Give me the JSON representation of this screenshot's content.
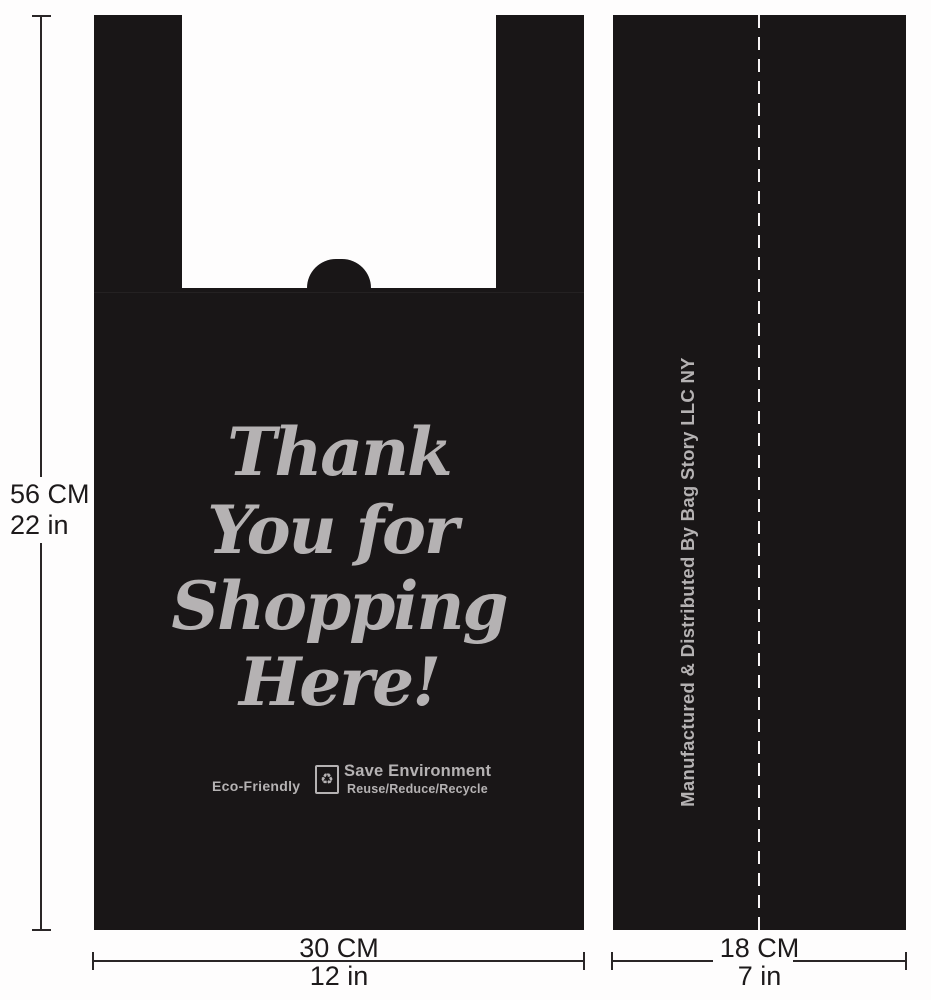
{
  "colors": {
    "bag_black": "#191617",
    "print_gray": "#b5b2b3",
    "line_dark": "#2a2627",
    "page_white": "#fefdfd"
  },
  "height_dimension": {
    "cm": "56 CM",
    "inches": "22 in"
  },
  "bag_front": {
    "print_lines": [
      "Thank",
      "You for",
      "Shopping",
      "Here!"
    ],
    "eco_label": "Eco-Friendly",
    "recycle_glyph": "♻",
    "save_environment": "Save Environment",
    "reuse_line": "Reuse/Reduce/Recycle"
  },
  "front_width_dimension": {
    "cm": "30 CM",
    "inches": "12 in"
  },
  "bag_side": {
    "vertical_text": "Manufactured & Distributed By Bag Story LLC NY"
  },
  "side_width_dimension": {
    "cm": "18 CM",
    "inches": "7 in"
  }
}
